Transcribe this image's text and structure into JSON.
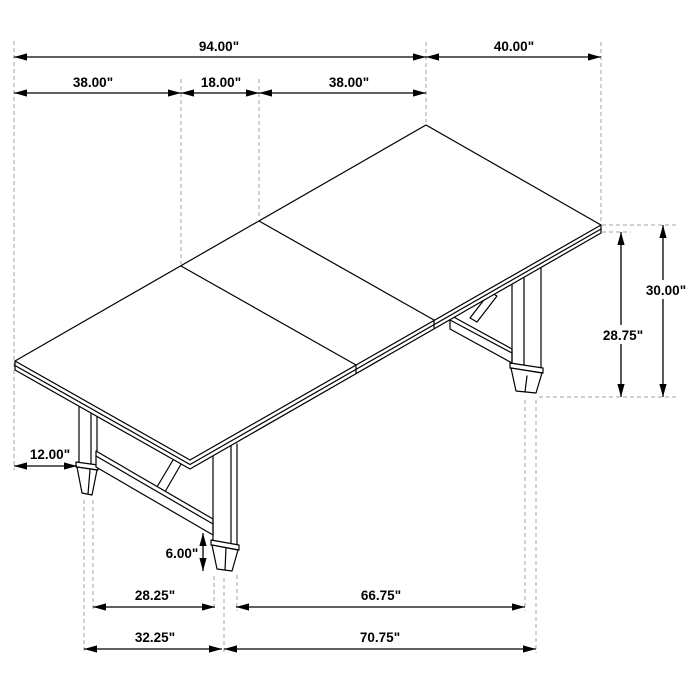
{
  "drawing": {
    "type": "furniture-dimension-diagram",
    "subject": "Trestle dining table with extension leaf, isometric line drawing with dimensions",
    "unit": "inches",
    "colors": {
      "line": "#000000",
      "extension_line": "#a3a3a3",
      "background": "#ffffff"
    },
    "dimensions": {
      "top": {
        "overall_length": "94.00\"",
        "end_width": "40.00\"",
        "left_section": "38.00\"",
        "leaf_section": "18.00\"",
        "right_section": "38.00\""
      },
      "right": {
        "overall_height": "30.00\"",
        "underside_height": "28.75\""
      },
      "left": {
        "leg_inset": "12.00\""
      },
      "base": {
        "foot_height": "6.00\"",
        "left_feet_inner_span": "28.25\"",
        "left_feet_outer_span": "32.25\"",
        "base_inner_span": "66.75\"",
        "base_outer_span": "70.75\""
      }
    }
  }
}
